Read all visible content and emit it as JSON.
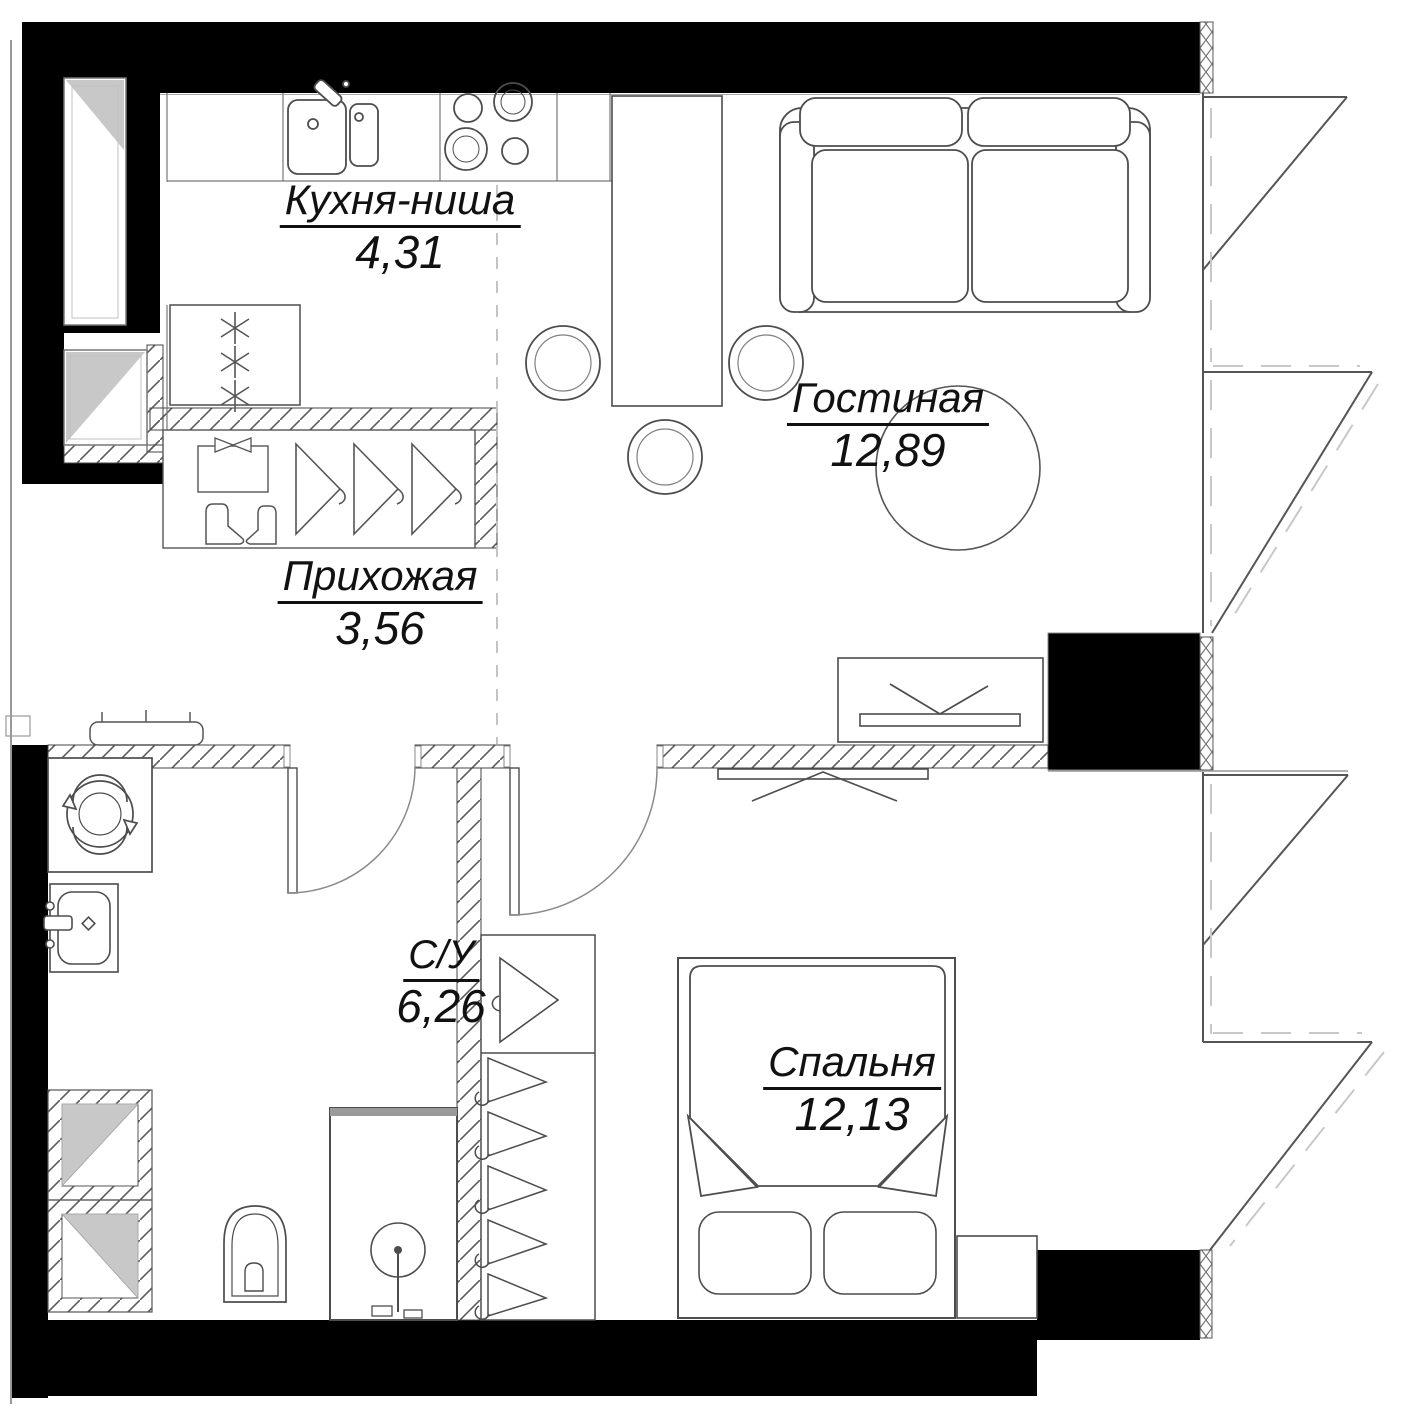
{
  "plan": {
    "rooms": [
      {
        "id": "kitchen",
        "label": "Кухня-ниша",
        "area": "4,31"
      },
      {
        "id": "living",
        "label": "Гостиная",
        "area": "12,89"
      },
      {
        "id": "hallway",
        "label": "Прихожая",
        "area": "3,56"
      },
      {
        "id": "bathroom",
        "label": "С/У",
        "area": "6,26"
      },
      {
        "id": "bedroom",
        "label": "Спальня",
        "area": "12,13"
      }
    ],
    "colors": {
      "walls": "#000000",
      "outlines": "#4d4d4d",
      "hatch": "#5a5a5a",
      "shade": "#c8c8c8",
      "dashes": "#c8c8c8",
      "text": "#111111",
      "background": "#ffffff"
    },
    "furniture": [
      "kitchen-sink",
      "stove",
      "fridge",
      "dining-table",
      "chairs",
      "sofa",
      "coffee-table",
      "tv-console",
      "hall-wardrobe",
      "bench",
      "washing-machine",
      "bath-sink",
      "toilet",
      "shower",
      "duct-shafts",
      "bedroom-wardrobe",
      "bed",
      "pillows",
      "nightstand",
      "sliding-door",
      "swing-doors",
      "bay-windows"
    ]
  }
}
